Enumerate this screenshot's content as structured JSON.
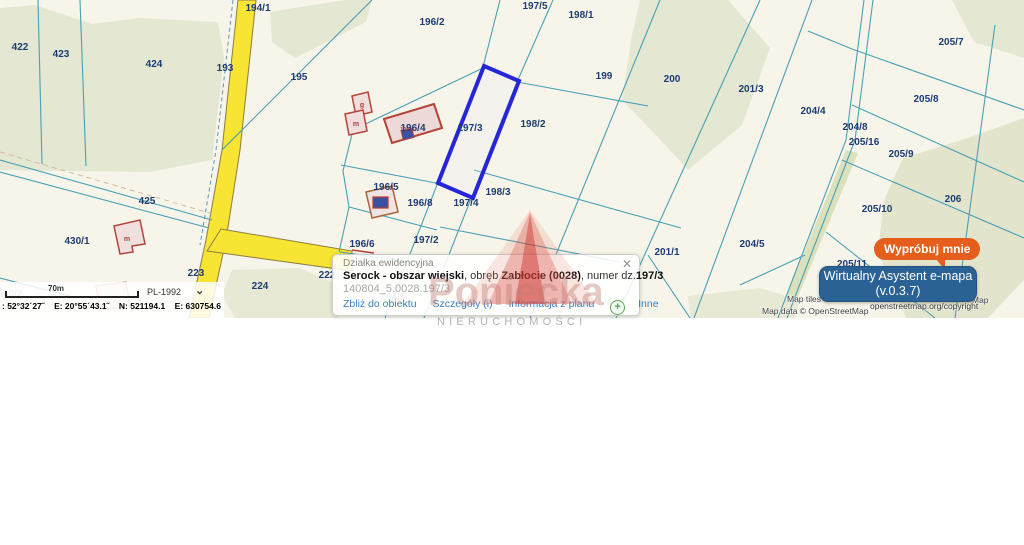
{
  "map": {
    "parcels": [
      {
        "label": "422"
      },
      {
        "label": "423"
      },
      {
        "label": "424"
      },
      {
        "label": "193"
      },
      {
        "label": "194/1"
      },
      {
        "label": "195"
      },
      {
        "label": "196/2"
      },
      {
        "label": "197/5"
      },
      {
        "label": "198/1"
      },
      {
        "label": "199"
      },
      {
        "label": "200"
      },
      {
        "label": "201/3"
      },
      {
        "label": "204/4"
      },
      {
        "label": "205/7"
      },
      {
        "label": "204/8"
      },
      {
        "label": "205/8"
      },
      {
        "label": "205/16"
      },
      {
        "label": "205/9"
      },
      {
        "label": "206"
      },
      {
        "label": "205/10"
      },
      {
        "label": "196/4"
      },
      {
        "label": "197/3"
      },
      {
        "label": "198/2"
      },
      {
        "label": "196/5"
      },
      {
        "label": "198/3"
      },
      {
        "label": "196/8"
      },
      {
        "label": "197/4"
      },
      {
        "label": "197/2"
      },
      {
        "label": "196/6"
      },
      {
        "label": "201/1"
      },
      {
        "label": "204/5"
      },
      {
        "label": "205/11"
      },
      {
        "label": "223"
      },
      {
        "label": "224"
      },
      {
        "label": "425"
      },
      {
        "label": "430/1"
      },
      {
        "label": "222"
      },
      {
        "label": "430/2"
      },
      {
        "label": "197/1"
      }
    ],
    "building_letters": [
      {
        "label": "g"
      },
      {
        "label": "m"
      },
      {
        "label": "m"
      }
    ],
    "building_red_label": "196/4",
    "highlighted_parcel": "197/3",
    "colors": {
      "background": "#f7f5ea",
      "field_green": "#e4e7d1",
      "boundary": "#4aa0b5",
      "road_yellow": "#f7e433",
      "highlight_blue": "#2626d8",
      "label_navy": "#1d3c74",
      "building_red": "#b5433a"
    }
  },
  "popup": {
    "title": "Działka ewidencyjna",
    "line1": {
      "bold1": "Serock - obszar wiejski",
      "sep1": ", obręb ",
      "bold2": "Zabłocie (0028)",
      "sep2": ", numer dz.",
      "bold3": "197/3"
    },
    "id_line": "140804_5.0028.197/3",
    "links": {
      "zoom": "Zbliż do obiektu",
      "details": "Szczegóły (i)",
      "plan_info": "Informacja z planu",
      "other": "Inne"
    }
  },
  "icons": {
    "close": "✕",
    "plus": "+",
    "chevron_down": "⌄"
  },
  "buttons": {
    "try_me": "Wypróbuj mnie",
    "assistant_line1": "Wirtualny Asystent e-mapa",
    "assistant_line2": "(v.0.3.7)"
  },
  "status_bar": {
    "scale_label": "70m",
    "crs": "PL-1992",
    "coords": ": 52°32´27˝    E: 20°55´43.1˝    N: 521194.1    E: 630754.6"
  },
  "attribution": {
    "tiles_left": "Map tiles",
    "tiles_right": "Map",
    "osm_link": "openstreetmap.org/copyright",
    "data_line": "Map data © OpenStreetMap"
  },
  "watermark": {
    "name": "Poniecka",
    "subtitle": "NIERUCHOMOŚCI"
  }
}
